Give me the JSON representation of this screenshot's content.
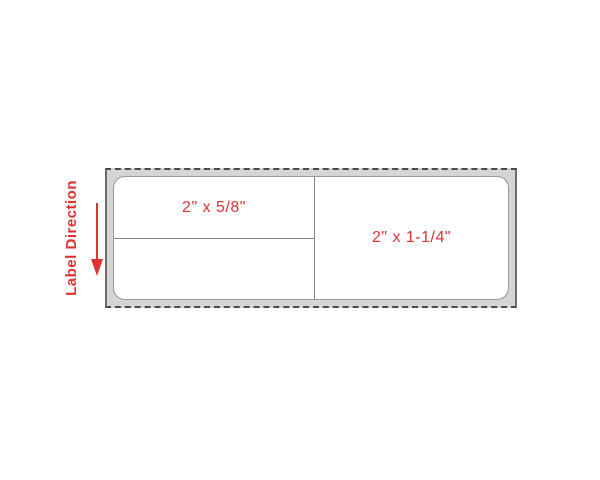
{
  "diagram": {
    "label_direction_text": "Label Direction",
    "cells": {
      "top_left_dimension": "2\" x 5/8\"",
      "right_dimension": "2\" x 1-1/4\""
    },
    "icons": {
      "direction_arrow": "down-arrow"
    }
  },
  "colors": {
    "accent_red": "#dd3333",
    "liner_gray": "#d5d5d5",
    "dash_border": "#4a4a4a",
    "label_border": "#999999",
    "divider": "#858585",
    "page_bg": "#ffffff"
  }
}
